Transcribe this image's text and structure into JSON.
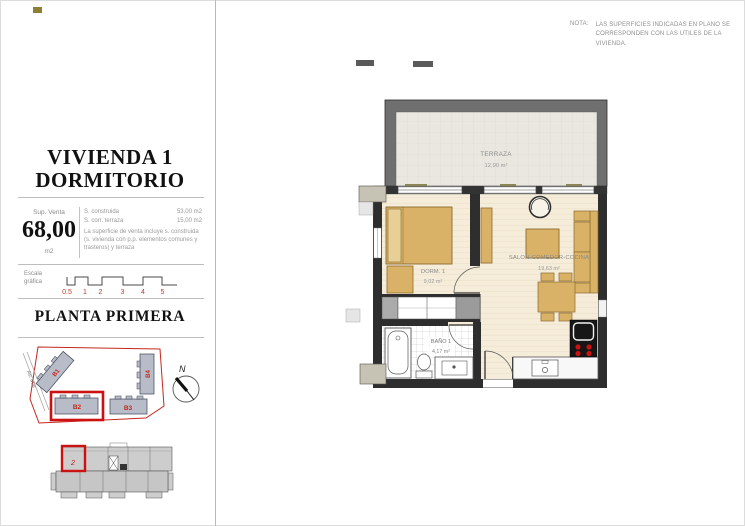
{
  "note": {
    "prefix": "NOTA:",
    "line1": "LAS SUPERFICIES INDICADAS EN PLANO SE",
    "line2": "CORRESPONDEN CON LAS UTILES DE LA VIVIENDA."
  },
  "panel": {
    "title_line1": "VIVIENDA 1",
    "title_line2": "DORMITORIO",
    "sup_venta": {
      "label": "Sup. Venta",
      "value": "68,00",
      "unit": "m2"
    },
    "surfaces": [
      {
        "label": "S. construida",
        "value": "53,00 m2"
      },
      {
        "label": "S. corr. terraza",
        "value": "15,00 m2"
      }
    ],
    "surface_note": "La superficie de venta incluye s. construida (s. vivienda con p.p. elementos comunes y trasteros) y terraza",
    "scale": {
      "label_line1": "Escala",
      "label_line2": "gráfica",
      "ticks": [
        "0.5",
        "1",
        "2",
        "3",
        "4",
        "5"
      ]
    },
    "floor_title": "PLANTA PRIMERA",
    "site_plan": {
      "street": "Av. Mar",
      "north_label": "N",
      "buildings": [
        {
          "label": "B1",
          "highlighted": false
        },
        {
          "label": "B4",
          "highlighted": false
        },
        {
          "label": "B2",
          "highlighted": true
        },
        {
          "label": "B3",
          "highlighted": false
        }
      ]
    },
    "key_plan": {
      "unit_mark": "2"
    }
  },
  "floor_plan": {
    "rooms": [
      {
        "name": "TERRAZA",
        "area": "12,90 m²"
      },
      {
        "name": "DORM. 1",
        "area": "9,02 m²"
      },
      {
        "name": "SALON-COMEDOR-COCINA",
        "area": "19,63 m²"
      },
      {
        "name": "BAÑO 1",
        "area": "4,17 m²"
      }
    ]
  },
  "colors": {
    "accent_red": "#cc1111",
    "wall_dark": "#2e2e2e",
    "terrace_wall": "#6f6f6f",
    "furniture_tan": "#d9b267",
    "floor_cream": "#f5ecd9",
    "building_gray": "#b7bcc8",
    "scale_number_red": "#c0392b"
  }
}
